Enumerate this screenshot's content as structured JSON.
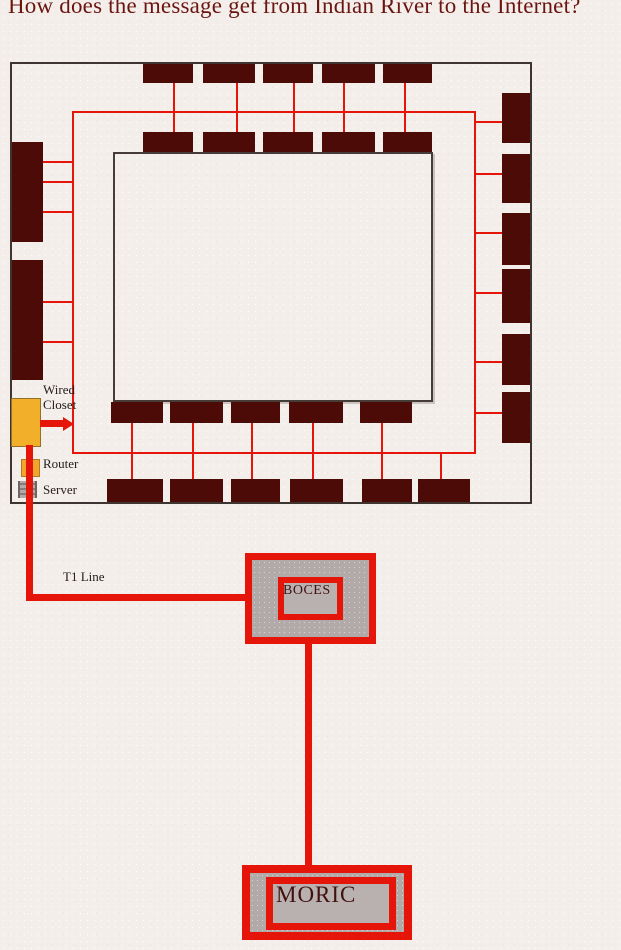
{
  "title": "How does the message get from Indian River to the Internet?",
  "labels": {
    "wired_closet_line1": "Wired",
    "wired_closet_line2": "Closet",
    "router": "Router",
    "server": "Server",
    "t1_line": "T1 Line",
    "boces": "BOCES",
    "moric": "MORIC"
  },
  "colors": {
    "background": "#f3eeea",
    "room_fill": "#4d0b07",
    "wire_red": "#e6150a",
    "wall": "#3e3531",
    "closet_fill": "#f2b02a",
    "router_fill": "#f2a42c",
    "server_fill": "#a9a1a1",
    "node_fill": "#b2a9a9",
    "title_text": "#6b1511",
    "label_text": "#241d1a",
    "node_text": "#42100d"
  },
  "floor_plan": {
    "rooms": [
      {
        "x": 143,
        "y": 64,
        "w": 50,
        "h": 19
      },
      {
        "x": 203,
        "y": 64,
        "w": 52,
        "h": 19
      },
      {
        "x": 263,
        "y": 64,
        "w": 50,
        "h": 19
      },
      {
        "x": 322,
        "y": 64,
        "w": 53,
        "h": 19
      },
      {
        "x": 383,
        "y": 64,
        "w": 49,
        "h": 19
      },
      {
        "x": 143,
        "y": 132,
        "w": 50,
        "h": 20
      },
      {
        "x": 203,
        "y": 132,
        "w": 52,
        "h": 20
      },
      {
        "x": 263,
        "y": 132,
        "w": 50,
        "h": 20
      },
      {
        "x": 322,
        "y": 132,
        "w": 53,
        "h": 20
      },
      {
        "x": 383,
        "y": 132,
        "w": 49,
        "h": 20
      },
      {
        "x": 12,
        "y": 142,
        "w": 31,
        "h": 100
      },
      {
        "x": 12,
        "y": 260,
        "w": 31,
        "h": 120
      },
      {
        "x": 502,
        "y": 93,
        "w": 28,
        "h": 50
      },
      {
        "x": 502,
        "y": 154,
        "w": 28,
        "h": 49
      },
      {
        "x": 502,
        "y": 213,
        "w": 28,
        "h": 52
      },
      {
        "x": 502,
        "y": 269,
        "w": 28,
        "h": 54
      },
      {
        "x": 502,
        "y": 334,
        "w": 28,
        "h": 51
      },
      {
        "x": 502,
        "y": 392,
        "w": 28,
        "h": 51
      },
      {
        "x": 111,
        "y": 402,
        "w": 52,
        "h": 21
      },
      {
        "x": 170,
        "y": 402,
        "w": 53,
        "h": 21
      },
      {
        "x": 231,
        "y": 402,
        "w": 49,
        "h": 21
      },
      {
        "x": 289,
        "y": 402,
        "w": 54,
        "h": 21
      },
      {
        "x": 360,
        "y": 402,
        "w": 52,
        "h": 21
      },
      {
        "x": 107,
        "y": 479,
        "w": 56,
        "h": 23
      },
      {
        "x": 170,
        "y": 479,
        "w": 53,
        "h": 23
      },
      {
        "x": 231,
        "y": 479,
        "w": 49,
        "h": 23
      },
      {
        "x": 290,
        "y": 479,
        "w": 53,
        "h": 23
      },
      {
        "x": 362,
        "y": 479,
        "w": 50,
        "h": 23
      },
      {
        "x": 418,
        "y": 479,
        "w": 52,
        "h": 23
      }
    ],
    "wires": [
      {
        "x": 72,
        "y": 111,
        "w": 404,
        "h": 2
      },
      {
        "x": 72,
        "y": 111,
        "w": 2,
        "h": 343
      },
      {
        "x": 474,
        "y": 111,
        "w": 2,
        "h": 343
      },
      {
        "x": 72,
        "y": 452,
        "w": 404,
        "h": 2
      },
      {
        "x": 173,
        "y": 83,
        "w": 2,
        "h": 49
      },
      {
        "x": 236,
        "y": 83,
        "w": 2,
        "h": 49
      },
      {
        "x": 293,
        "y": 83,
        "w": 2,
        "h": 49
      },
      {
        "x": 343,
        "y": 83,
        "w": 2,
        "h": 49
      },
      {
        "x": 404,
        "y": 83,
        "w": 2,
        "h": 49
      },
      {
        "x": 476,
        "y": 121,
        "w": 26,
        "h": 2
      },
      {
        "x": 476,
        "y": 173,
        "w": 26,
        "h": 2
      },
      {
        "x": 476,
        "y": 232,
        "w": 26,
        "h": 2
      },
      {
        "x": 476,
        "y": 292,
        "w": 26,
        "h": 2
      },
      {
        "x": 476,
        "y": 361,
        "w": 26,
        "h": 2
      },
      {
        "x": 476,
        "y": 412,
        "w": 26,
        "h": 2
      },
      {
        "x": 43,
        "y": 161,
        "w": 29,
        "h": 2
      },
      {
        "x": 43,
        "y": 181,
        "w": 29,
        "h": 2
      },
      {
        "x": 43,
        "y": 211,
        "w": 29,
        "h": 2
      },
      {
        "x": 43,
        "y": 301,
        "w": 29,
        "h": 2
      },
      {
        "x": 43,
        "y": 341,
        "w": 29,
        "h": 2
      },
      {
        "x": 131,
        "y": 423,
        "w": 2,
        "h": 56
      },
      {
        "x": 192,
        "y": 423,
        "w": 2,
        "h": 56
      },
      {
        "x": 251,
        "y": 423,
        "w": 2,
        "h": 56
      },
      {
        "x": 312,
        "y": 423,
        "w": 2,
        "h": 56
      },
      {
        "x": 381,
        "y": 423,
        "w": 2,
        "h": 56
      },
      {
        "x": 440,
        "y": 454,
        "w": 2,
        "h": 25
      }
    ],
    "thick_wires": [
      {
        "x": 40,
        "y": 420,
        "w": 25,
        "h": 7
      },
      {
        "x": 26,
        "y": 445,
        "w": 7,
        "h": 153
      },
      {
        "x": 26,
        "y": 594,
        "w": 219,
        "h": 7
      },
      {
        "x": 305,
        "y": 643,
        "w": 7,
        "h": 223
      }
    ]
  }
}
